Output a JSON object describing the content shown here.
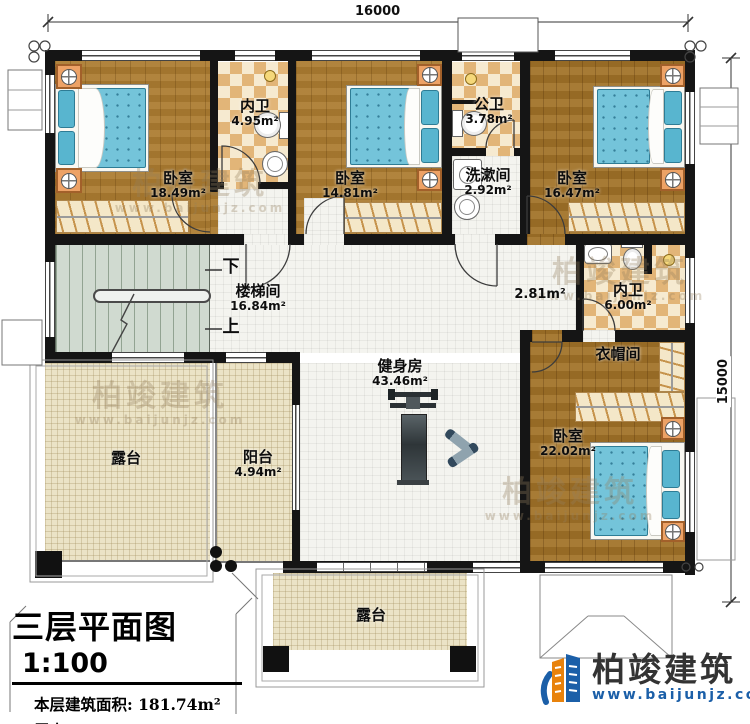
{
  "dimensions": {
    "top": "16000",
    "right": "15000"
  },
  "rooms": {
    "bedroom1": {
      "name": "卧室",
      "area": "18.49m²"
    },
    "neiwei1": {
      "name": "内卫",
      "area": "4.95m²"
    },
    "bedroom2": {
      "name": "卧室",
      "area": "14.81m²"
    },
    "gongwei": {
      "name": "公卫",
      "area": "3.78m²"
    },
    "xishujian": {
      "name": "洗漱间",
      "area": "2.92m²"
    },
    "bedroom3": {
      "name": "卧室",
      "area": "16.47m²"
    },
    "corridor": {
      "area": "2.81m²"
    },
    "neiwei2": {
      "name": "内卫",
      "area": "6.00m²"
    },
    "cloakroom": {
      "name": "衣帽间"
    },
    "stairwell": {
      "name": "楼梯间",
      "area": "16.84m²",
      "down": "下",
      "up": "上"
    },
    "gym": {
      "name": "健身房",
      "area": "43.46m²"
    },
    "balcony": {
      "name": "阳台",
      "area": "4.94m²"
    },
    "terrace_left": {
      "name": "露台"
    },
    "terrace_bottom": {
      "name": "露台"
    },
    "bedroom4": {
      "name": "卧室",
      "area": "22.02m²"
    }
  },
  "title": {
    "main": "三层平面图",
    "scale": "1:100",
    "building_area": "本层建筑面积: 181.74m²",
    "floor_height": "层高: 3.3m"
  },
  "logo": {
    "name": "柏竣建筑",
    "url": "www.baijunjz.com"
  },
  "watermark": {
    "text": "柏竣建筑",
    "url": "www.baijunjz.com"
  }
}
